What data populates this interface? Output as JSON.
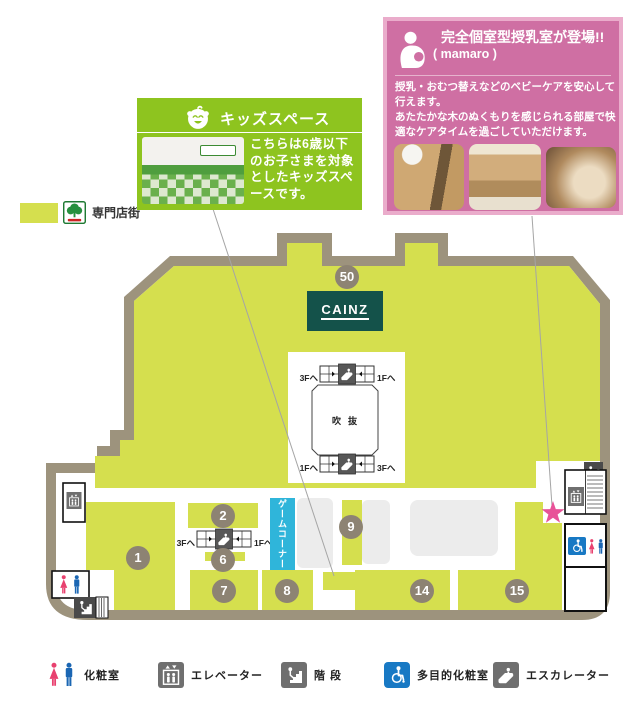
{
  "store_legend": {
    "label": "専門店街"
  },
  "kids_callout": {
    "title": "キッズスペース",
    "body": "こちらは6歳以下のお子さまを対象としたキッズスペースです。"
  },
  "mamaro_callout": {
    "title": "完全個室型授乳室が登場!!",
    "subtitle": "( mamaro )",
    "body_line1": "授乳・おむつ替えなどのベビーケアを安心して行えます。",
    "body_line2": "あたたかな木のぬくもりを感じられる部屋で快適なケアタイムを過ごしていただけます。"
  },
  "map": {
    "anchor_store": "CAINZ",
    "atrium": "吹抜",
    "game_corner": "ゲームコーナー",
    "to_3f": "3Fへ",
    "to_1f": "1Fへ",
    "units": {
      "u50": "50",
      "u1": "1",
      "u2": "2",
      "u6": "6",
      "u7": "7",
      "u8": "8",
      "u9": "9",
      "u14": "14",
      "u15": "15"
    }
  },
  "legend": {
    "restroom": "化粧室",
    "elevator": "エレベーター",
    "stairs": "階 段",
    "accessible": "多目的化粧室",
    "escalator": "エスカレーター"
  },
  "colors": {
    "floor": "#d5df4e",
    "wall": "#9d937d",
    "unit_badge": "#8d8373",
    "cainz_green": "#14524a",
    "game_cyan": "#2fb5da",
    "aisle_gray": "#ececec",
    "mamaro_pink": "#cf6fa3",
    "kids_green": "#8ec41f",
    "star_pink": "#e85298",
    "female_pink": "#e8416f",
    "male_blue": "#1b66b3",
    "accessible_blue": "#1879c4",
    "icon_gray": "#6f6f6f"
  }
}
